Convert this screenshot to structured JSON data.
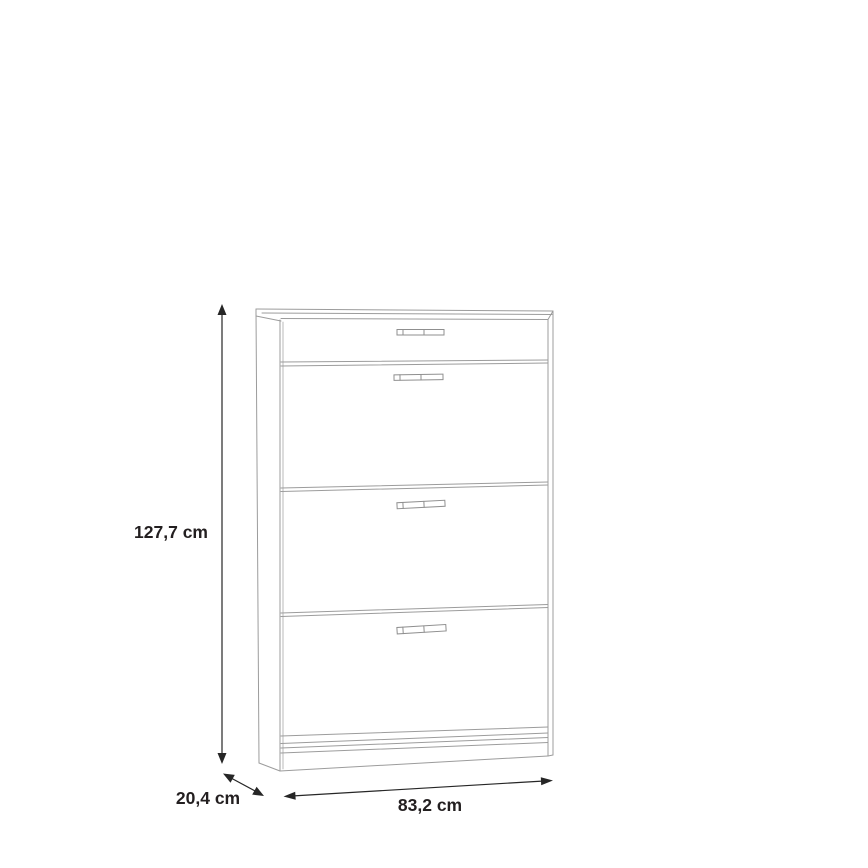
{
  "drawing": {
    "kind": "furniture-dimension-line-drawing",
    "item": "shoe-cabinet-with-one-drawer-and-three-flap-doors",
    "background_color": "#ffffff",
    "outline_color": "#9c9c9c",
    "dimension_color": "#262626",
    "label_color": "#231f20"
  },
  "dimensions": {
    "height": {
      "value": "127,7 cm"
    },
    "depth": {
      "value": "20,4 cm"
    },
    "width": {
      "value": "83,2 cm"
    }
  }
}
